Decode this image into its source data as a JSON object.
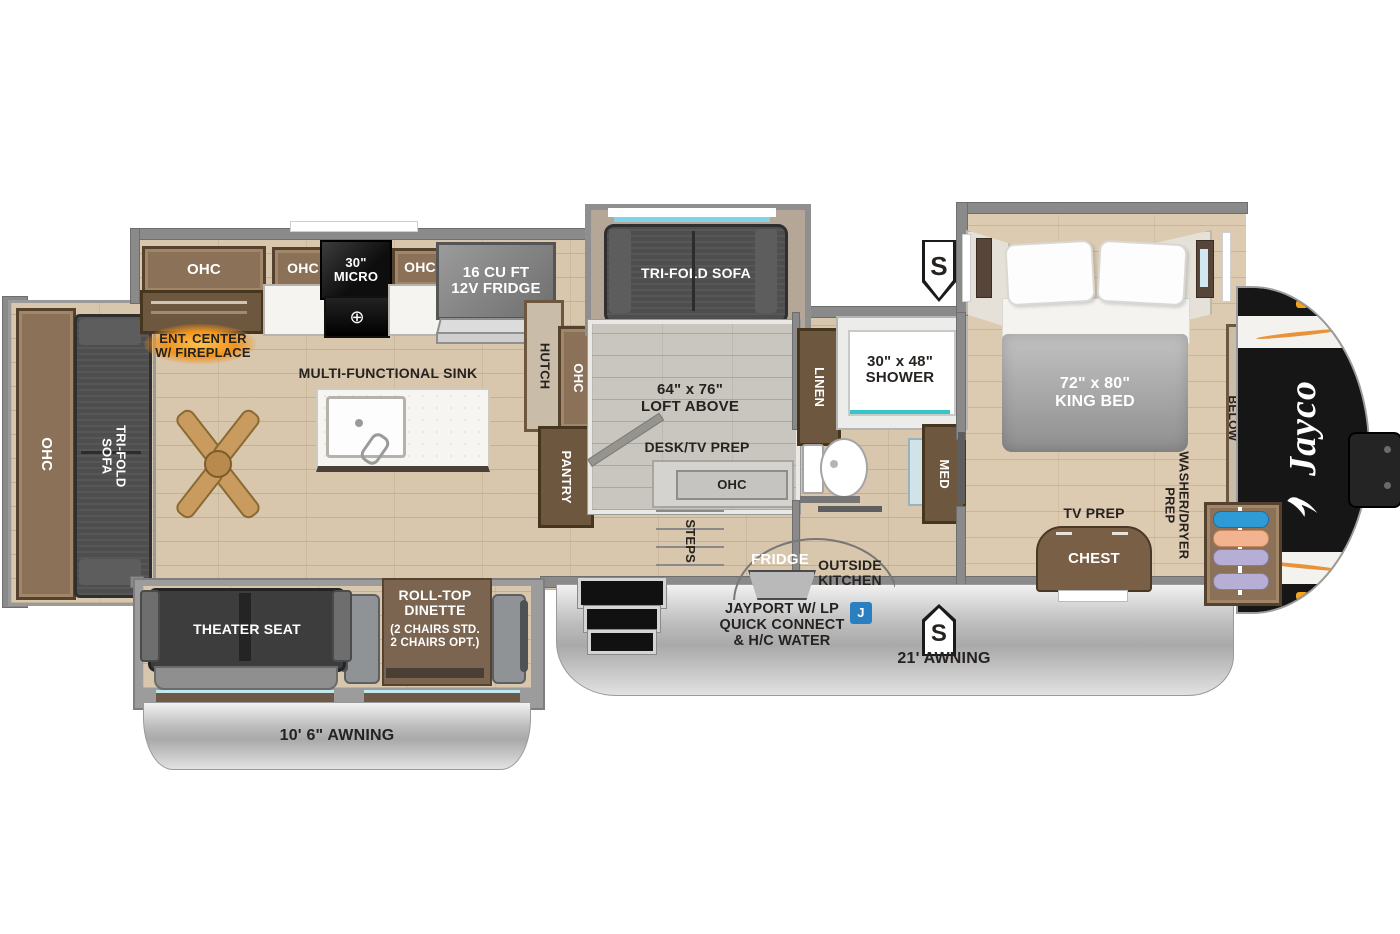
{
  "floorplan": {
    "brand_logo": "Jayco",
    "rear_slide": {
      "ohc": "OHC",
      "sofa": "TRI-FOLD SOFA"
    },
    "kitchen": {
      "ohc_left": "OHC",
      "ent_center": "ENT. CENTER\nW/ FIREPLACE",
      "ohc_mid": "OHC",
      "micro": "30\"\nMICRO",
      "ohc_right": "OHC",
      "fridge": "16 CU FT\n12V FRIDGE",
      "sink": "MULTI-FUNCTIONAL SINK",
      "hutch": "HUTCH",
      "hutch_ohc": "OHC",
      "pantry": "PANTRY"
    },
    "loft_slide": {
      "sofa": "TRI-FOLD SOFA"
    },
    "loft": {
      "label": "64\" x 76\"\nLOFT ABOVE",
      "desk": "DESK/TV PREP",
      "ohc": "OHC",
      "steps": "STEPS"
    },
    "bathroom": {
      "linen": "LINEN",
      "shower": "30\" x 48\"\nSHOWER",
      "med": "MED"
    },
    "bedroom": {
      "bed": "72\" x 80\"\nKING BED",
      "tv_prep": "TV PREP",
      "chest": "CHEST",
      "shelves": "SHELVES W/\nDRAWERS BELOW",
      "washer_dryer": "WASHER/DRYER\nPREP"
    },
    "living": {
      "theater_seat": "THEATER SEAT",
      "dinette": "ROLL-TOP\nDINETTE",
      "dinette_note": "(2 CHAIRS STD.\n2 CHAIRS OPT.)"
    },
    "exterior": {
      "awning_left": "10' 6\" AWNING",
      "awning_right": "21' AWNING",
      "jayport": "JAYPORT W/ LP\nQUICK CONNECT\n& H/C WATER",
      "outside_fridge": "FRIDGE",
      "outside_kitchen": "OUTSIDE\nKITCHEN",
      "badge_s": "S",
      "badge_j": "J"
    }
  },
  "colors": {
    "wall": "#8a8a8a",
    "floor_wood": "#d8c6ad",
    "cabinet": "#8a7158",
    "cabinet_dark": "#6e573f",
    "fireplace_orange": "#f0941e",
    "badge_blue": "#2a7fc1",
    "sofa_gray": "#4e4e4e",
    "skirt_silver": "#c9c9c9",
    "shower_teal": "#37c5c8",
    "cap_black": "#161616",
    "marker_amber": "#f2a61c"
  }
}
